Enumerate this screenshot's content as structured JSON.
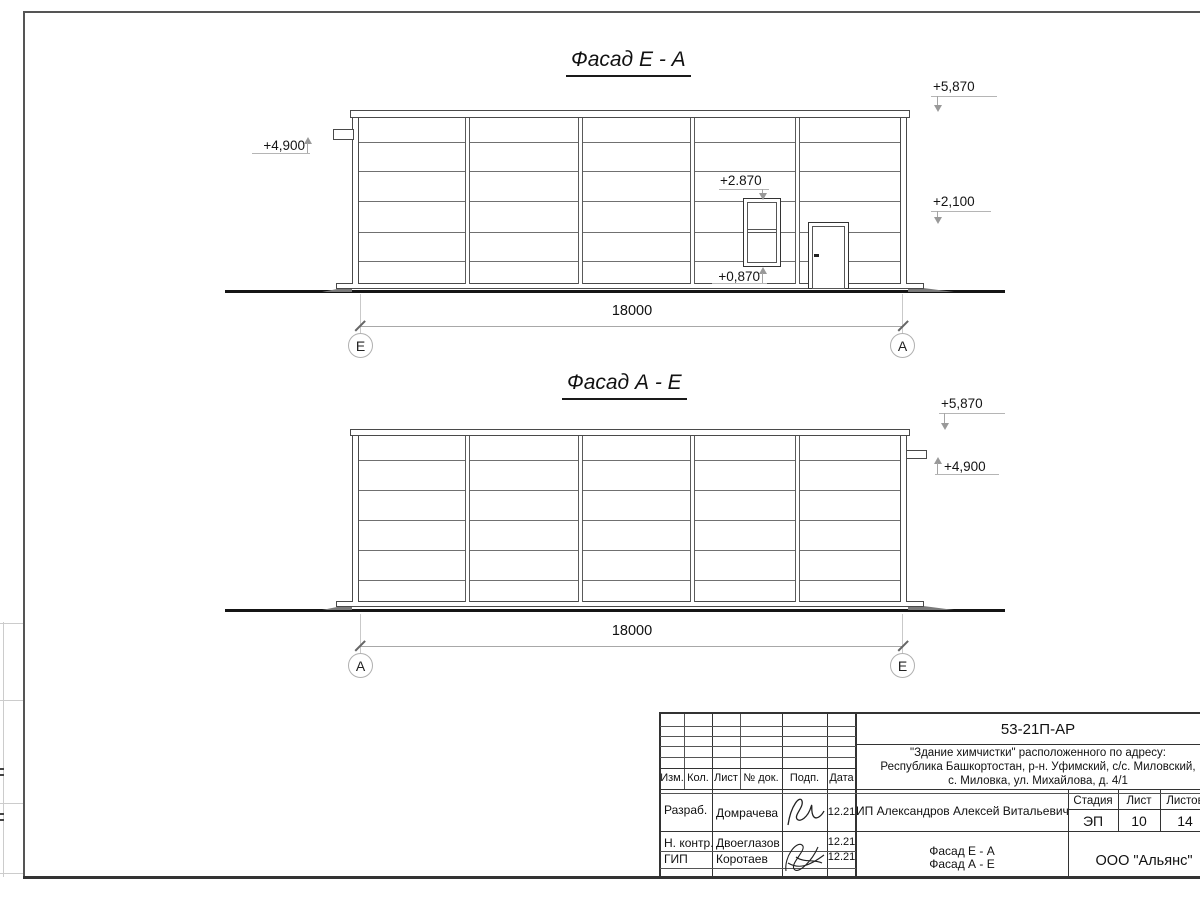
{
  "facades": [
    {
      "title": "Фасад Е - А",
      "dim": "18000",
      "axis_left": "Е",
      "axis_right": "А",
      "mark_roof": "+5,870",
      "mark_mid": "+2,100",
      "mark_pipe": "+4,900",
      "mark_window_top": "+2.870",
      "mark_window_bottom": "+0,870"
    },
    {
      "title": "Фасад А - Е",
      "dim": "18000",
      "axis_left": "А",
      "axis_right": "Е",
      "mark_roof": "+5,870",
      "mark_pipe": "+4,900"
    }
  ],
  "title_block": {
    "code": "53-21П-АР",
    "address_lines": [
      "\"Здание химчистки\" расположенного по адресу:",
      "Республика Башкортостан, р-н. Уфимский, с/с. Миловский,",
      "с. Миловка, ул. Михайлова, д. 4/1"
    ],
    "header_cols": [
      "Изм.",
      "Кол.",
      "Лист",
      "№ док.",
      "Подп.",
      "Дата"
    ],
    "rows": [
      {
        "role": "Разраб.",
        "name": "Домрачева",
        "date": "12.21"
      },
      {
        "role": "Н. контр.",
        "name": "Двоеглазов",
        "date": "12.21"
      },
      {
        "role": "ГИП",
        "name": "Коротаев",
        "date": "12.21"
      }
    ],
    "client": "ИП Александров Алексей Витальевич",
    "stage_label": "Стадия",
    "sheet_label": "Лист",
    "sheets_label": "Листов",
    "stage": "ЭП",
    "sheet": "10",
    "sheets": "14",
    "sheet_title_line1": "Фасад Е - А",
    "sheet_title_line2": "Фасад А - Е",
    "company": "ООО \"Альянс\""
  }
}
